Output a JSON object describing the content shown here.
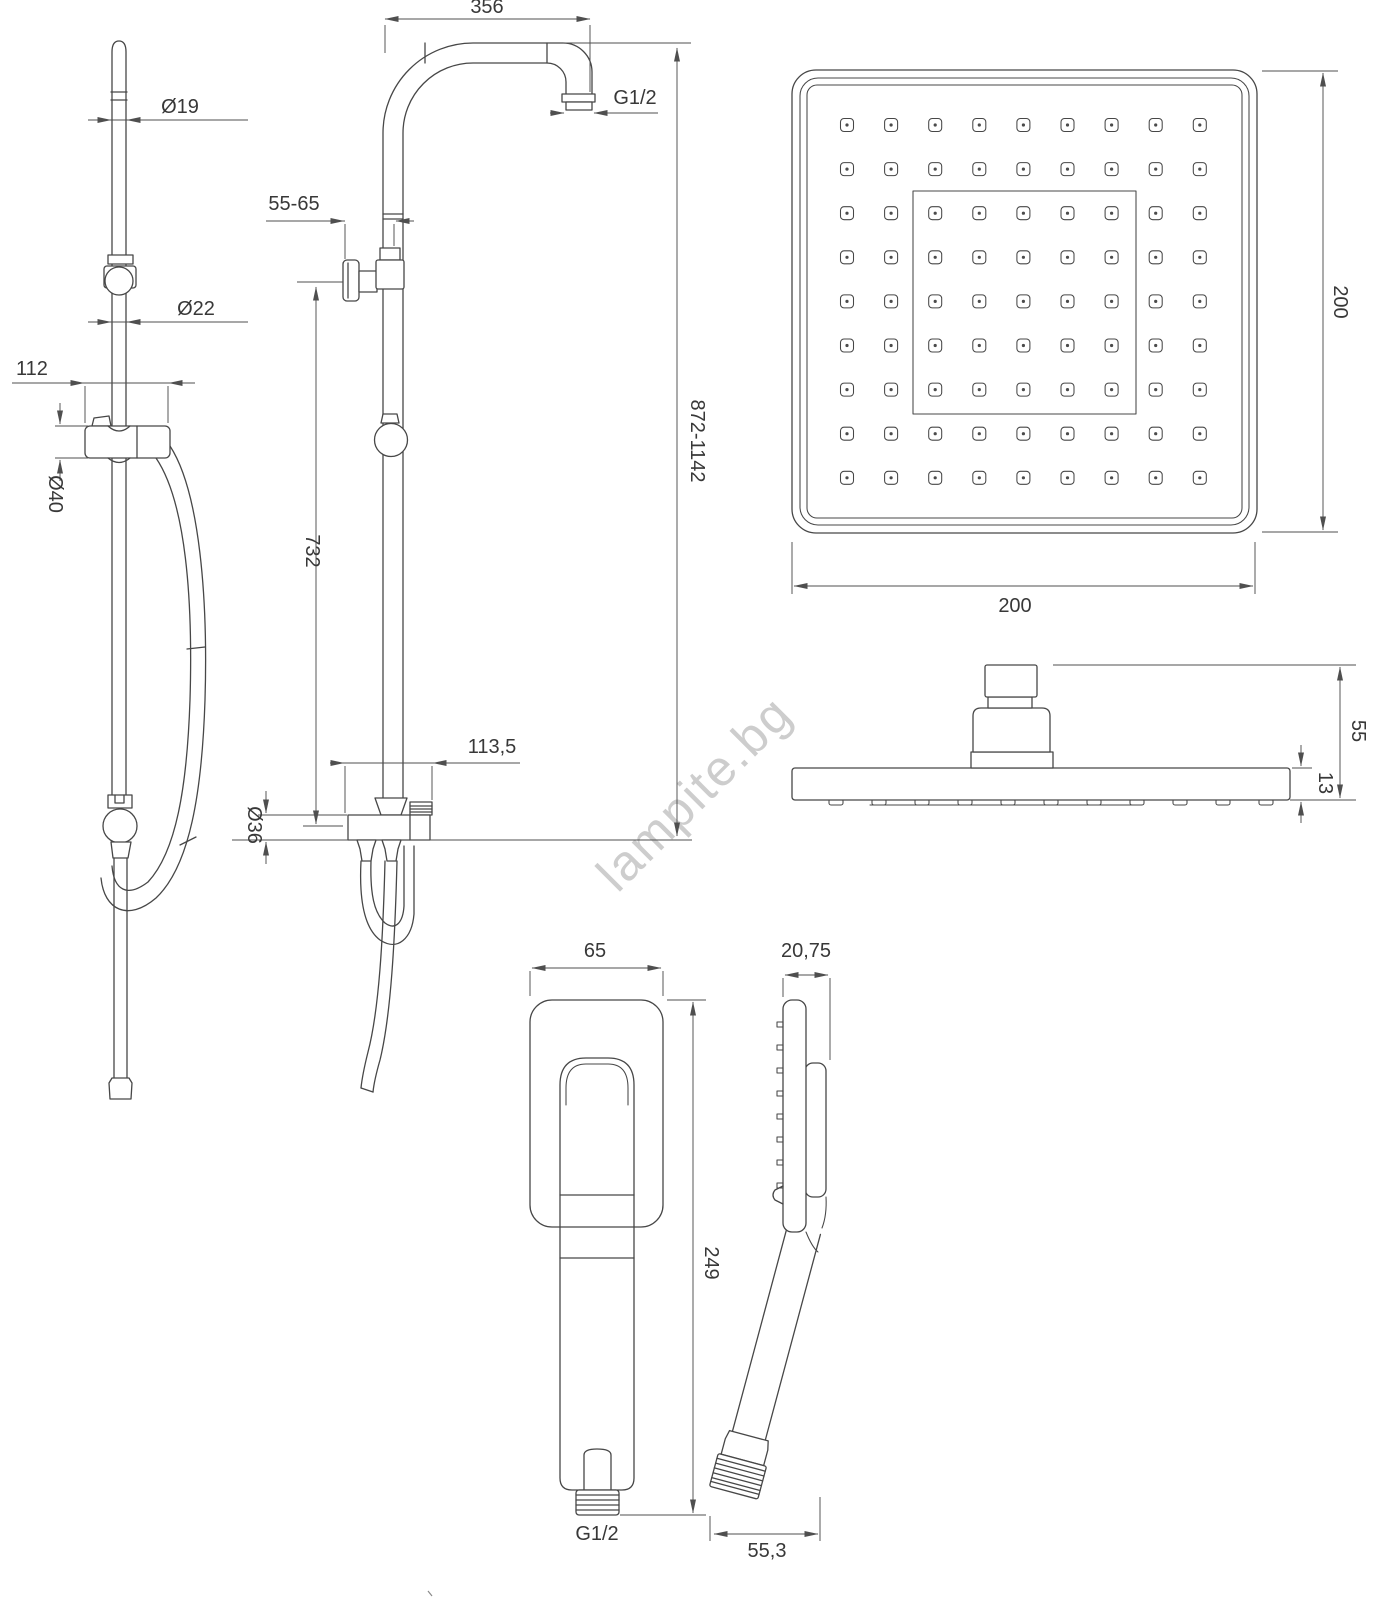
{
  "colors": {
    "line": "#474747",
    "dimension": "#4f4f4f",
    "label": "#383838",
    "watermark": "#cdcdcd",
    "background": "#ffffff"
  },
  "watermark": {
    "text": "lampite.bg"
  },
  "rail_side_view": {
    "dia_top": "Ø19",
    "dia_bottom": "Ø22",
    "holder_width": "112",
    "holder_dia": "Ø40"
  },
  "column_view": {
    "arm_length": "356",
    "top_thread": "G1/2",
    "wall_distance": "55-65",
    "rail_height": "732",
    "total_height": "872-1142",
    "spout_offset": "113,5",
    "tee_dia": "Ø36"
  },
  "head_top_view": {
    "width": "200",
    "height": "200"
  },
  "head_side_view": {
    "total_height": "55",
    "plate_thickness": "13"
  },
  "hand_front_view": {
    "width": "65",
    "length": "249",
    "thread": "G1/2"
  },
  "hand_side_view": {
    "depth": "20,75",
    "bottom_width": "55,3"
  }
}
